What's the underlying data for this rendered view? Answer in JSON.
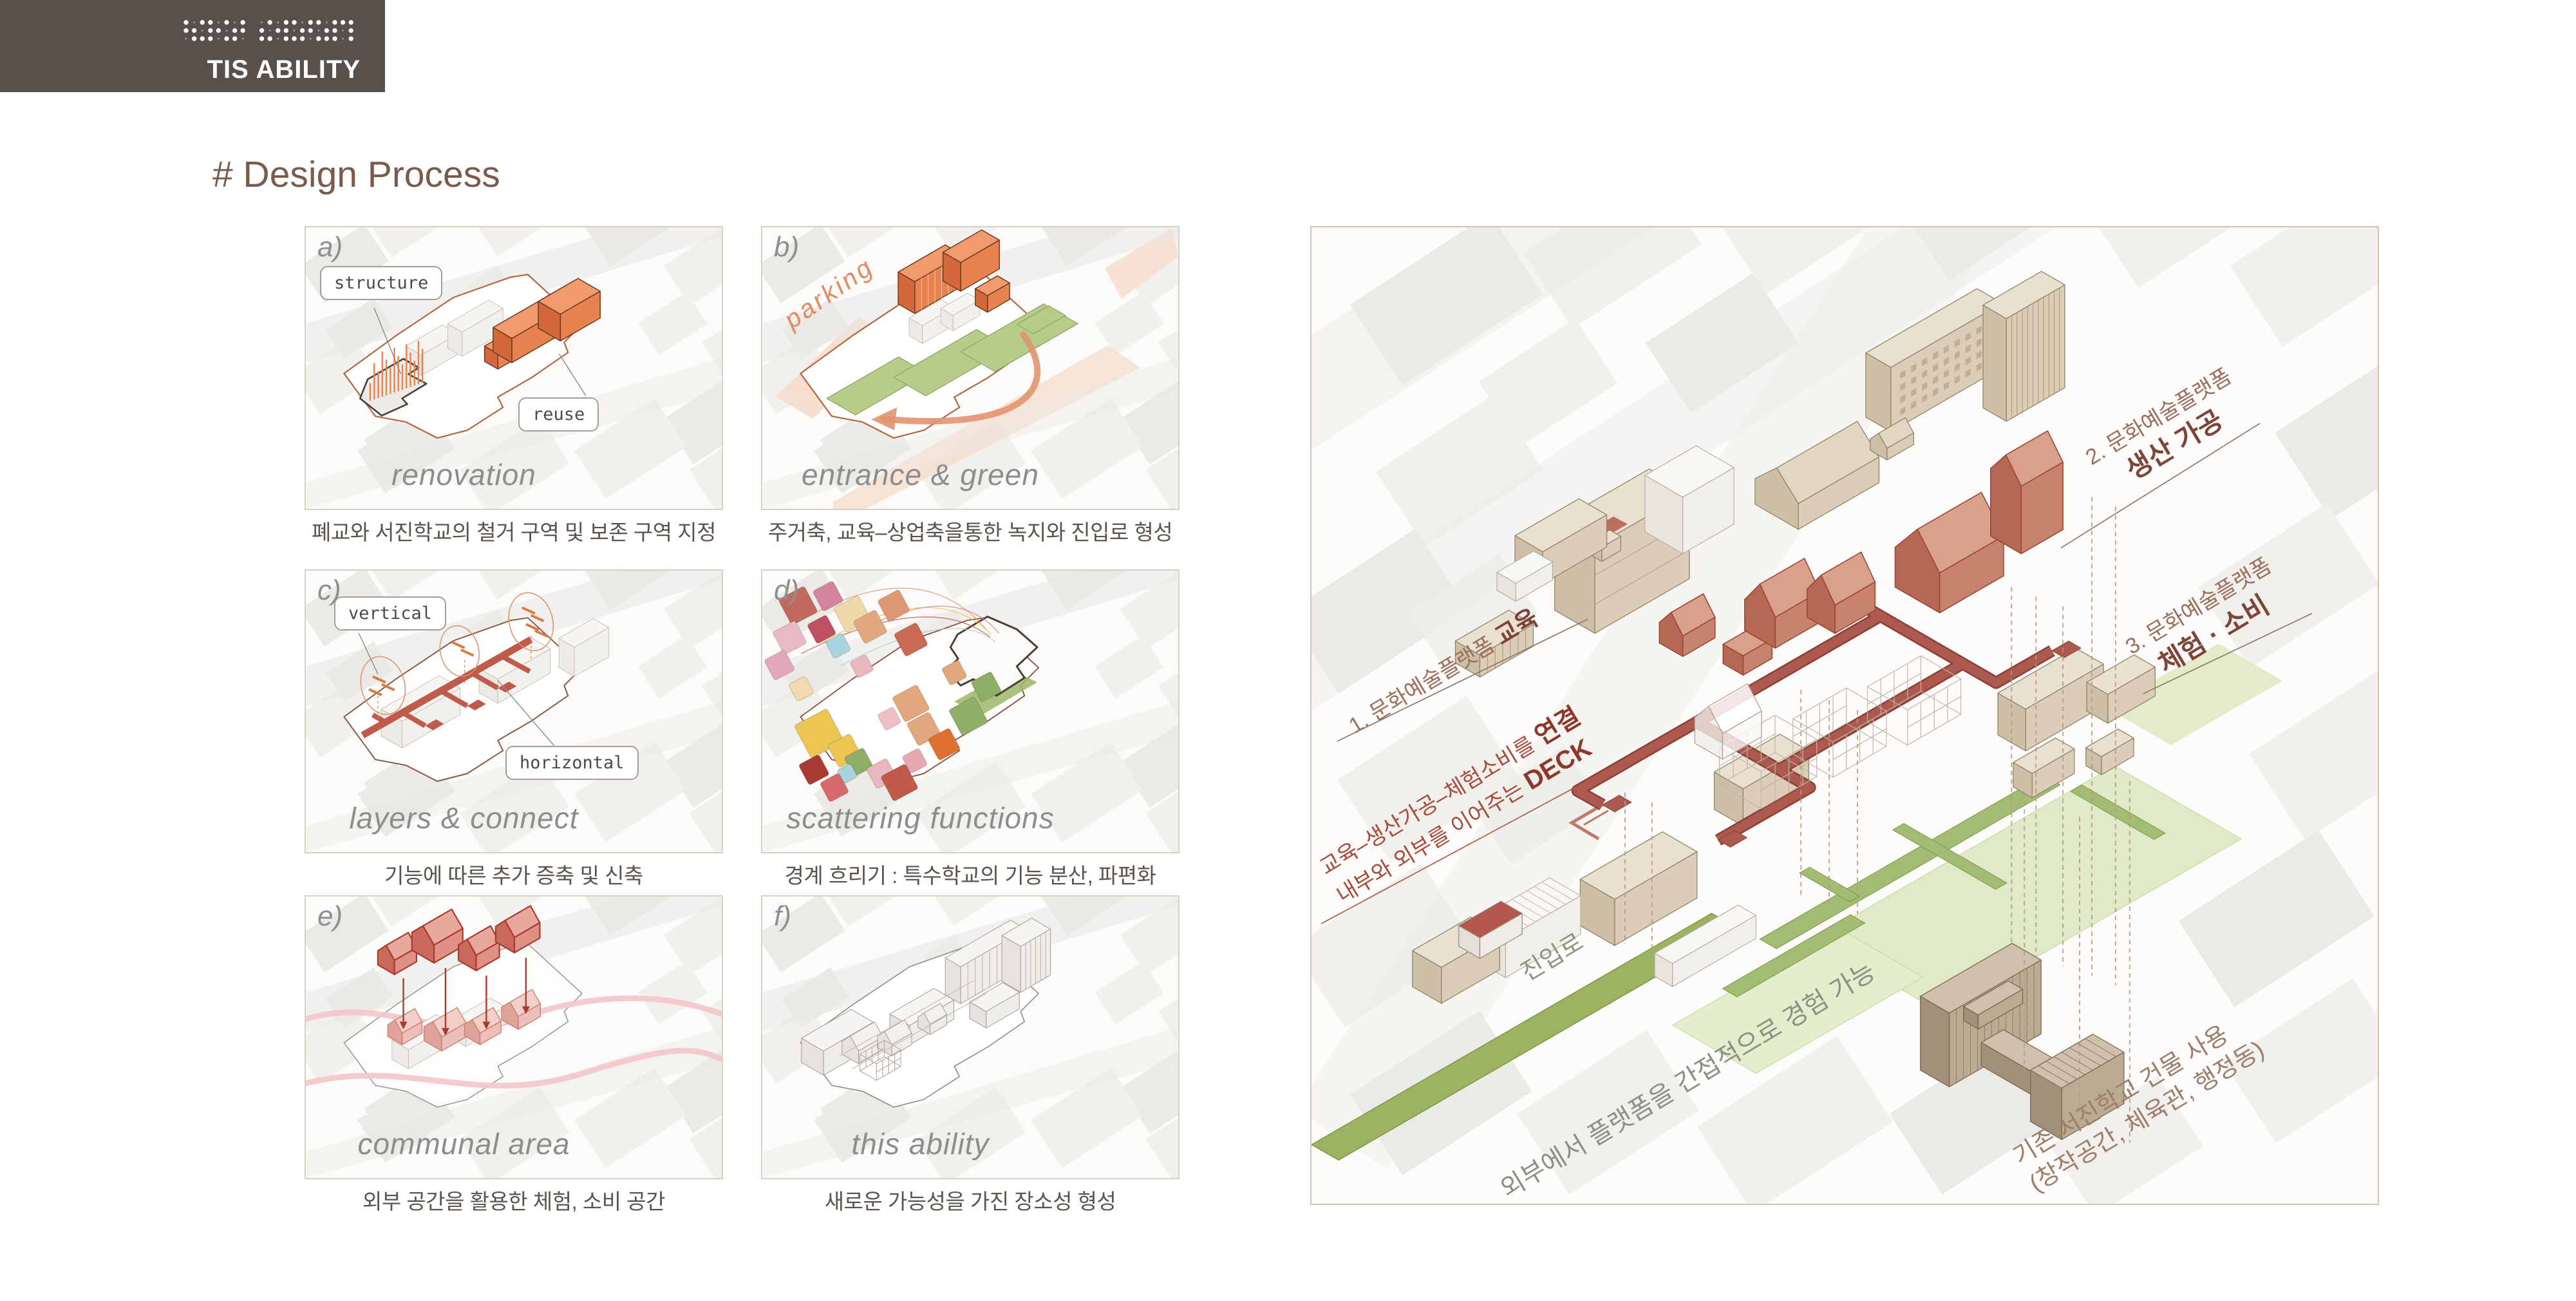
{
  "header": {
    "brand": "TIS ABILITY"
  },
  "title": "# Design Process",
  "panels": [
    {
      "letter": "a)",
      "title_en": "renovation",
      "caption": "폐교와 서진학교의 철거 구역 및 보존 구역 지정",
      "tags": {
        "tag1": "structure",
        "tag2": "reuse"
      }
    },
    {
      "letter": "b)",
      "title_en": "entrance & green",
      "caption": "주거축, 교육–상업축을통한 녹지와 진입로 형성",
      "tags": {
        "tag1": "parking"
      }
    },
    {
      "letter": "c)",
      "title_en": "layers & connect",
      "caption": "기능에 따른 추가 증축 및 신축",
      "tags": {
        "tag1": "vertical",
        "tag2": "horizontal"
      }
    },
    {
      "letter": "d)",
      "title_en": "scattering functions",
      "caption": "경계 흐리기 : 특수학교의 기능 분산, 파편화",
      "tags": {}
    },
    {
      "letter": "e)",
      "title_en": "communal area",
      "caption": "외부 공간을 활용한 체험, 소비 공간",
      "tags": {}
    },
    {
      "letter": "f)",
      "title_en": "this ability",
      "caption": "새로운 가능성을 가진 장소성 형성",
      "tags": {}
    }
  ],
  "diagram": {
    "ann1_prefix": "1. 문화예술플랫폼 ",
    "ann1_bold": "교육",
    "ann2_prefix": "2. 문화예술플랫폼",
    "ann2_bold": "생산 가공",
    "ann3_prefix": "3. 문화예술플랫폼",
    "ann3_bold": "체험 · 소비",
    "deck_l1_prefix": "교육–생산가공–체험소비를 ",
    "deck_l1_bold": "연결",
    "deck_l2_prefix": "내부와 외부를 이어주는 ",
    "deck_l2_bold": "DECK",
    "entrance": "진입로",
    "experience": "외부에서 플랫폼을 간접적으로 경험 가능",
    "existing_l1": "기존 서진학교 건물 사용",
    "existing_l2": "(창작공간, 체육관, 행정동)"
  },
  "colors": {
    "header_bg": "#57504b",
    "title_brown": "#7a5b4b",
    "accent_orange": "#e8824e",
    "deck_red": "#a6524a",
    "green": "#9db35f",
    "annotation_red": "#a84b3a"
  }
}
